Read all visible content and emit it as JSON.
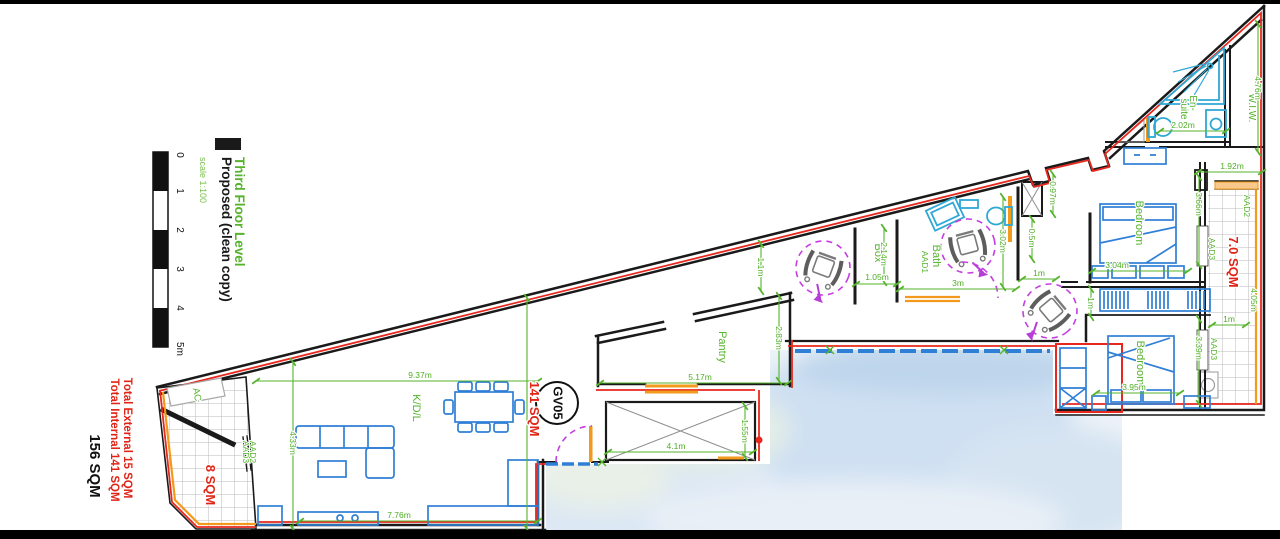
{
  "title_block": {
    "project": "Proposed (clean copy)",
    "level": "Third Floor Level",
    "scale": "scale 1:100"
  },
  "scale_bar": {
    "ticks": [
      "0",
      "1",
      "2",
      "3",
      "4",
      "5m"
    ]
  },
  "totals": {
    "external": "Total External 15 SQM",
    "internal": "Total Internal 141 SQM",
    "combined": "156 SQM"
  },
  "areas": {
    "left_terrace": "8 SQM",
    "main_internal": "141 SQM",
    "right_balcony": "7.0 SQM"
  },
  "unit_label": "GV05",
  "rooms": {
    "kdl": "K/D/L",
    "pantry": "Pantry",
    "box": "Box",
    "bath": "Bath",
    "bath_code": "AAD1",
    "bedroom1": "Bedroom",
    "bedroom2": "Bedroom",
    "ensuite_l1": "En-",
    "ensuite_l2": "suite",
    "wiw": "W.I.W.",
    "ac": "AC"
  },
  "apertures": {
    "terrace_a": "AAD3",
    "terrace_b": "AAD2",
    "balcony_top": "AAD2",
    "balcony_mid": "AAD3",
    "balcony_low": "AAD3"
  },
  "dims": {
    "kdl_w": "9.37m",
    "kdl_h": "4.33m",
    "kitchen_w": "7.76m",
    "pantry_w": "5.17m",
    "pantry_h": "2.83m",
    "pantry_gap": "1.1m",
    "shaft_w": "4.1m",
    "shaft_h": "1.55m",
    "box_h": "2.14m",
    "box_w": "1.05m",
    "bath_w": "3m",
    "bath_h": "3.02m",
    "lobby_w": "0.5m",
    "hall_1m_a": "1m",
    "shaft2_h": "0.97m",
    "ensuite_w": "2.02m",
    "wiw_h": "4.76m",
    "wiw_w": "1.92m",
    "bed1_h": "3.66m",
    "bed1_w": "3.04m",
    "hall_1m_b": "1m",
    "bed2_h": "3.39m",
    "bed2_w": "3.95m",
    "balcony_1m": "1m",
    "balcony_h": "4.05m"
  },
  "colors": {
    "wall": "#1a1a1a",
    "highlight_red": "#e8281e",
    "dim_green": "#55b32c",
    "furniture_blue": "#2f7fd6",
    "fixture_cyan": "#2fa8d5",
    "door_orange": "#f29a1b",
    "access_magenta": "#c43fe0",
    "area_red": "#e02517"
  }
}
